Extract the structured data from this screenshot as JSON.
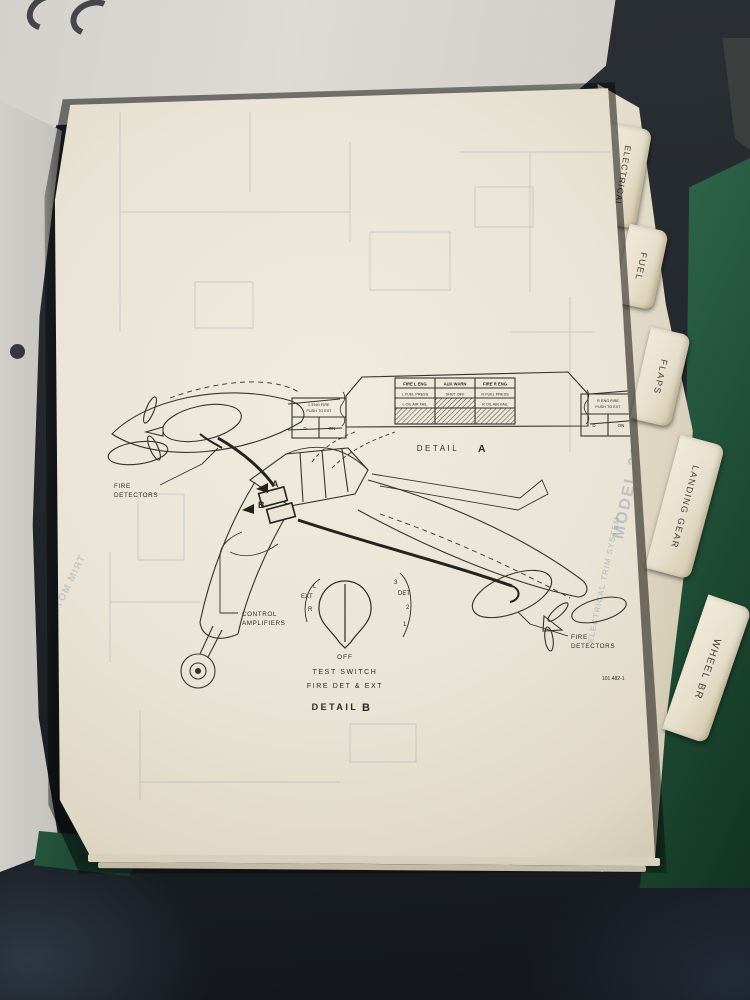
{
  "tabs": {
    "items": [
      {
        "label": "ELECTRICAL"
      },
      {
        "label": "FUEL"
      },
      {
        "label": "FLAPS"
      },
      {
        "label": "LANDING GEAR"
      },
      {
        "label": "WHEEL BR"
      }
    ]
  },
  "page": {
    "detail_a": {
      "caption": "DETAIL",
      "caption_letter": "A",
      "annunciator": {
        "headers": [
          "FIRE L ENG",
          "AUX WARN",
          "FIRE R ENG"
        ],
        "row2": [
          "L FUEL PRESS",
          "SHUT OFF",
          "R FUEL PRESS"
        ],
        "row3": [
          "L OIL AIR FAIL",
          "",
          "R OIL AIR FAIL"
        ]
      },
      "left_switch": {
        "title1": "L ENG FIRE",
        "title2": "PUSH TO EXT",
        "cell1": "D",
        "cell2": "ON"
      },
      "right_switch": {
        "title1": "R ENG FIRE",
        "title2": "PUSH TO EXT",
        "cell1": "D",
        "cell2": "ON"
      }
    },
    "labels": {
      "fire_detectors_left_1": "FIRE",
      "fire_detectors_left_2": "DETECTORS",
      "fire_detectors_right_1": "FIRE",
      "fire_detectors_right_2": "DETECTORS",
      "control_amplifiers_1": "CONTROL",
      "control_amplifiers_2": "AMPLIFIERS",
      "callout_a": "A",
      "callout_b": "B"
    },
    "detail_b": {
      "pos_left": [
        "L",
        "EXT",
        "R"
      ],
      "pos_right": [
        "3",
        "DET",
        "2",
        "1"
      ],
      "off": "OFF",
      "line1": "TEST SWITCH",
      "line2": "FIRE DET & EXT",
      "caption": "DETAIL",
      "caption_letter": "B"
    },
    "figure_number": "101 482-1",
    "ghost": {
      "model": "MODEL 20",
      "system": "ELECTRICAL TRIM SYSTEM",
      "trim_motor": "TRIM MOTOR"
    }
  }
}
